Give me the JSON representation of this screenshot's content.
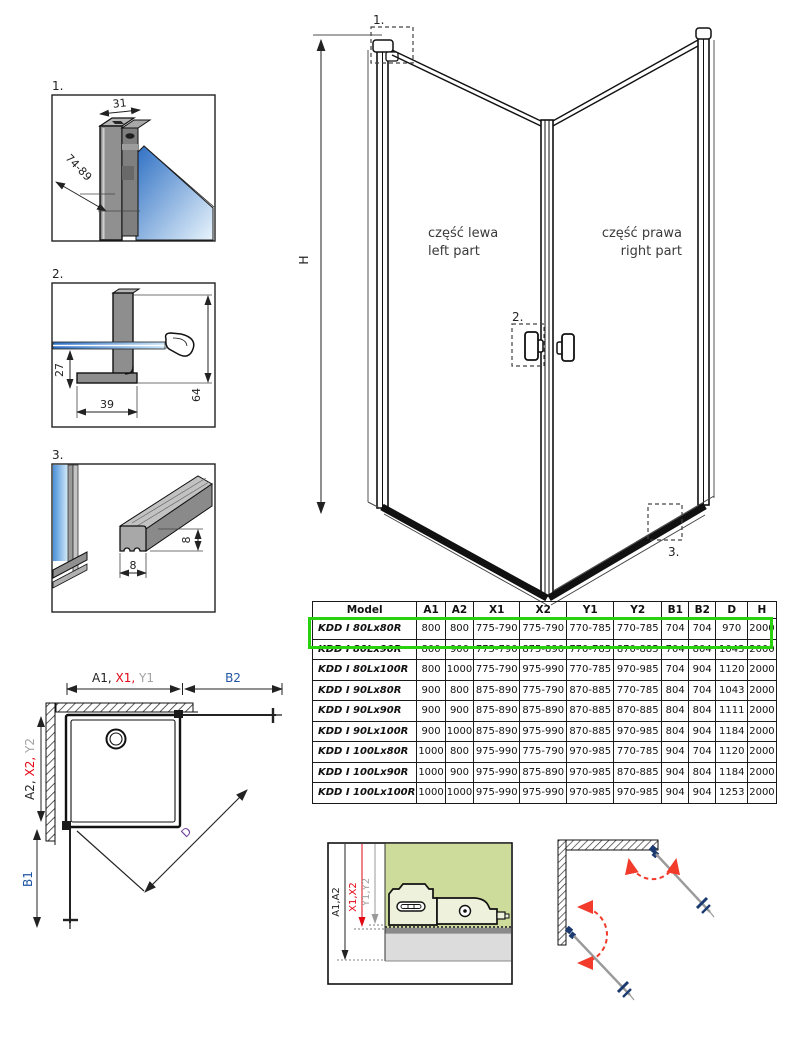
{
  "colors": {
    "accent_red": "#e30613",
    "accent_gray": "#a2a2a2",
    "accent_blue": "#2156a5",
    "accent_purple": "#7040a0",
    "highlight_green": "#28d20c",
    "glass_blue": "#3b7fd4",
    "panel_green": "#cddb9b",
    "swing_red": "#f23b2b"
  },
  "details": {
    "d1": {
      "label": "1.",
      "dim_width": "31",
      "dim_range": "74-89"
    },
    "d2": {
      "label": "2.",
      "dim_offset": "27",
      "dim_depth": "39",
      "dim_height": "64"
    },
    "d3": {
      "label": "3.",
      "dim_w": "8",
      "dim_h": "8"
    }
  },
  "main_drawing": {
    "height_label": "H",
    "marker1": "1.",
    "marker2": "2.",
    "marker3": "3.",
    "left_part_pl": "część lewa",
    "left_part_en": "left part",
    "right_part_pl": "część prawa",
    "right_part_en": "right part"
  },
  "table": {
    "headers": [
      {
        "label": "Model",
        "color": "black"
      },
      {
        "label": "A1",
        "color": "black"
      },
      {
        "label": "A2",
        "color": "black"
      },
      {
        "label": "X1",
        "color": "red"
      },
      {
        "label": "X2",
        "color": "red"
      },
      {
        "label": "Y1",
        "color": "gray"
      },
      {
        "label": "Y2",
        "color": "gray"
      },
      {
        "label": "B1",
        "color": "blue"
      },
      {
        "label": "B2",
        "color": "blue"
      },
      {
        "label": "D",
        "color": "purple"
      },
      {
        "label": "H",
        "color": "black"
      }
    ],
    "rows": [
      {
        "model": "KDD I 80Lx80R",
        "values": [
          "800",
          "800",
          "775-790",
          "775-790",
          "770-785",
          "770-785",
          "704",
          "704",
          "970",
          "2000"
        ],
        "highlighted": true
      },
      {
        "model": "KDD I 80Lx90R",
        "values": [
          "800",
          "900",
          "775-790",
          "875-890",
          "770-785",
          "870-885",
          "704",
          "804",
          "1043",
          "2000"
        ]
      },
      {
        "model": "KDD I 80Lx100R",
        "values": [
          "800",
          "1000",
          "775-790",
          "975-990",
          "770-785",
          "970-985",
          "704",
          "904",
          "1120",
          "2000"
        ]
      },
      {
        "model": "KDD I 90Lx80R",
        "values": [
          "900",
          "800",
          "875-890",
          "775-790",
          "870-885",
          "770-785",
          "804",
          "704",
          "1043",
          "2000"
        ]
      },
      {
        "model": "KDD I 90Lx90R",
        "values": [
          "900",
          "900",
          "875-890",
          "875-890",
          "870-885",
          "870-885",
          "804",
          "804",
          "1111",
          "2000"
        ]
      },
      {
        "model": "KDD I 90Lx100R",
        "values": [
          "900",
          "1000",
          "875-890",
          "975-990",
          "870-885",
          "970-985",
          "804",
          "904",
          "1184",
          "2000"
        ]
      },
      {
        "model": "KDD I 100Lx80R",
        "values": [
          "1000",
          "800",
          "975-990",
          "775-790",
          "970-985",
          "770-785",
          "904",
          "704",
          "1120",
          "2000"
        ]
      },
      {
        "model": "KDD I 100Lx90R",
        "values": [
          "1000",
          "900",
          "975-990",
          "875-890",
          "970-985",
          "870-885",
          "904",
          "804",
          "1184",
          "2000"
        ]
      },
      {
        "model": "KDD I 100Lx100R",
        "values": [
          "1000",
          "1000",
          "975-990",
          "975-990",
          "970-985",
          "970-985",
          "904",
          "904",
          "1253",
          "2000"
        ]
      }
    ]
  },
  "plan_view": {
    "dim_a1": "A1,",
    "dim_x1": " X1,",
    "dim_y1": " Y1",
    "dim_b2": "B2",
    "dim_a2": "A2,",
    "dim_x2": " X2,",
    "dim_y2": " Y2",
    "dim_b1": "B1",
    "dim_d": "D"
  },
  "section_view": {
    "dim_a": "A1,A2",
    "dim_x": "X1,X2",
    "dim_y": "Y1,Y2"
  }
}
